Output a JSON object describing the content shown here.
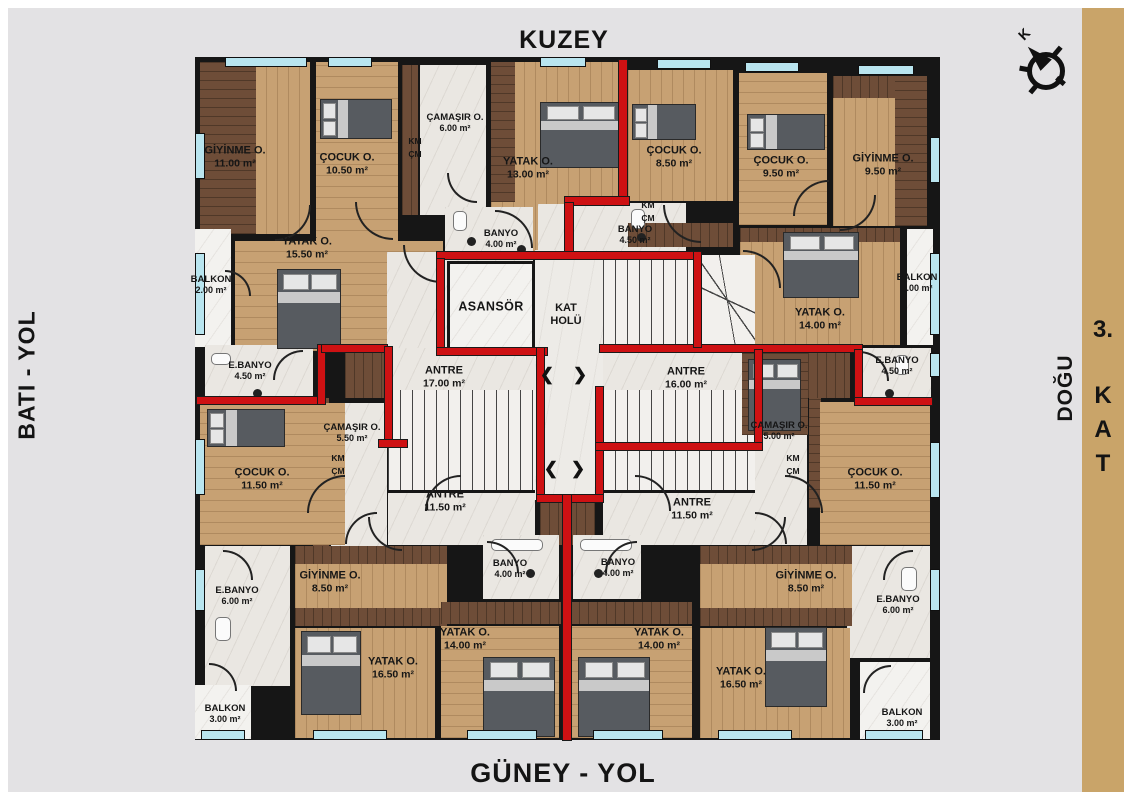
{
  "edges": {
    "north": "KUZEY",
    "south": "GÜNEY - YOL",
    "west": "BATI - YOL",
    "east": "DOĞU",
    "floor_number": "3.",
    "floor_k": "K",
    "floor_a": "A",
    "floor_t": "T"
  },
  "compass": {
    "label": "K"
  },
  "core": {
    "elevator": "ASANSÖR",
    "hall_1": "KAT",
    "hall_2": "HOLÜ",
    "arrow_left": "❮",
    "arrow_right": "❯"
  },
  "tags": {
    "km": "KM",
    "cm": "ÇM"
  },
  "colors": {
    "boundary_red": "#ce1113",
    "window_glass": "#b9e5ef",
    "wood_floor": "#c7a173",
    "dark_wood": "#6e4d38",
    "side_strip": "#c9a469"
  },
  "rooms": {
    "giyinme_nw": {
      "name": "GİYİNME O.",
      "area": "11.00 m²"
    },
    "cocuk_nw": {
      "name": "ÇOCUK O.",
      "area": "10.50 m²"
    },
    "camasir_nw": {
      "name": "ÇAMAŞIR O.",
      "area": "6.00 m²"
    },
    "yatak_nw": {
      "name": "YATAK O.",
      "area": "13.00 m²"
    },
    "yatak_nw2": {
      "name": "YATAK O.",
      "area": "15.50 m²"
    },
    "balkon_nw": {
      "name": "BALKON",
      "area": "2.00 m²"
    },
    "ebanyo_nw": {
      "name": "E.BANYO",
      "area": "4.50 m²"
    },
    "banyo_nw": {
      "name": "BANYO",
      "area": "4.00 m²"
    },
    "banyo_ne": {
      "name": "BANYO",
      "area": "4.50 m²"
    },
    "cocuk_ne1": {
      "name": "ÇOCUK O.",
      "area": "8.50 m²"
    },
    "cocuk_ne2": {
      "name": "ÇOCUK O.",
      "area": "9.50 m²"
    },
    "giyinme_ne": {
      "name": "GİYİNME O.",
      "area": "9.50 m²"
    },
    "yatak_ne": {
      "name": "YATAK O.",
      "area": "14.00 m²"
    },
    "balkon_ne": {
      "name": "BALKON",
      "area": "2.00 m²"
    },
    "ebanyo_ne": {
      "name": "E.BANYO",
      "area": "4.50 m²"
    },
    "antre_nw": {
      "name": "ANTRE",
      "area": "17.00 m²"
    },
    "antre_ne": {
      "name": "ANTRE",
      "area": "16.00 m²"
    },
    "camasir_sw": {
      "name": "ÇAMAŞIR O.",
      "area": "5.50 m²"
    },
    "camasir_se": {
      "name": "ÇAMAŞIR O.",
      "area": "5.00 m²"
    },
    "cocuk_sw": {
      "name": "ÇOCUK O.",
      "area": "11.50 m²"
    },
    "cocuk_se": {
      "name": "ÇOCUK O.",
      "area": "11.50 m²"
    },
    "antre_sw": {
      "name": "ANTRE",
      "area": "11.50 m²"
    },
    "antre_se": {
      "name": "ANTRE",
      "area": "11.50 m²"
    },
    "banyo_sw": {
      "name": "BANYO",
      "area": "4.00 m²"
    },
    "banyo_se": {
      "name": "BANYO",
      "area": "4.00 m²"
    },
    "ebanyo_sw": {
      "name": "E.BANYO",
      "area": "6.00 m²"
    },
    "ebanyo_se": {
      "name": "E.BANYO",
      "area": "6.00 m²"
    },
    "giyinme_sw": {
      "name": "GİYİNME O.",
      "area": "8.50 m²"
    },
    "giyinme_se": {
      "name": "GİYİNME O.",
      "area": "8.50 m²"
    },
    "yatak_sw1": {
      "name": "YATAK O.",
      "area": "16.50 m²"
    },
    "yatak_sw2": {
      "name": "YATAK O.",
      "area": "14.00 m²"
    },
    "yatak_se1": {
      "name": "YATAK O.",
      "area": "14.00 m²"
    },
    "yatak_se2": {
      "name": "YATAK O.",
      "area": "16.50 m²"
    },
    "balkon_sw": {
      "name": "BALKON",
      "area": "3.00 m²"
    },
    "balkon_se": {
      "name": "BALKON",
      "area": "3.00 m²"
    }
  }
}
